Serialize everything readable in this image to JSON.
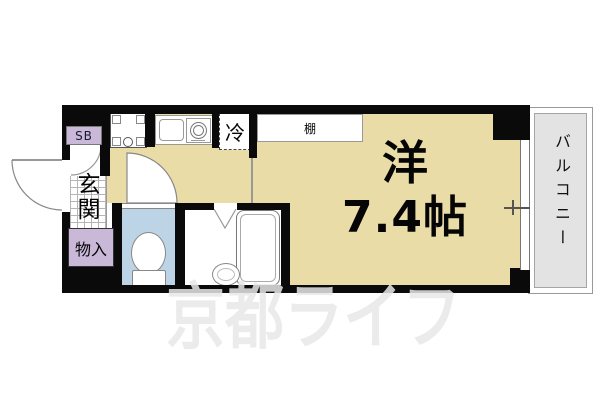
{
  "plan": {
    "entrance": {
      "shoe_box_label": "SB",
      "genkan_label": "玄関",
      "storage_label": "物入"
    },
    "kitchen": {
      "refrigerator_label": "冷"
    },
    "main_room": {
      "type_label": "洋",
      "size_label": "7.4帖",
      "shelf_label": "棚"
    },
    "balcony": {
      "label": "バルコニー"
    }
  },
  "watermark": {
    "text": "京都ライフ"
  },
  "colors": {
    "floor_fill": "#EADCA6",
    "storage_fill": "#C9B8D8",
    "toilet_fill": "#BCD4E6",
    "balcony_fill": "#E3E3E3",
    "wall": "#0a0a0a",
    "watermark": "rgba(231,231,231,0.85)"
  }
}
